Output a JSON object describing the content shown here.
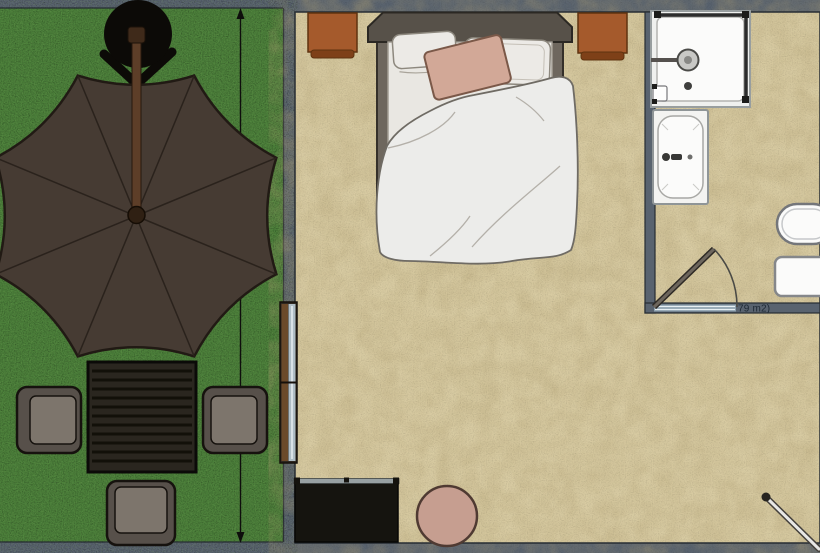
{
  "labels": {
    "area": "79 m2)"
  },
  "colors": {
    "wall": "#59636f",
    "wall_edge": "#262c33",
    "grass": "#4b7f3a",
    "floor": "#d8cba2",
    "umbrella": "#463b33",
    "umbrella_outline": "#211a14",
    "umbrella_rib": "#2a221c",
    "pole": "#5d3e28",
    "stand": "#0c0a07",
    "table": "#2a261f",
    "table_slat": "#121009",
    "chair_frame": "#57504a",
    "chair_seat": "#7d756c",
    "nightstand": "#a55a2c",
    "nightstand_edge": "#7e4018",
    "headboard": "#575149",
    "bed_frame": "#6e675e",
    "mattress": "#e9e7e2",
    "pillow": "#eceae6",
    "accent_pillow": "#d2a897",
    "duvet": "#ececea",
    "window_frame": "#6b4a2a",
    "window_glass": "#aebcc4",
    "tv": "#15140f",
    "tv_top": "#97a0a2",
    "pouf": "#c69e90",
    "fixture": "#fbfbfa",
    "fixture_border": "#85878a",
    "glass_door": "#2c2c2c",
    "threshold": "#8fa3b0",
    "label_text": "#1d2833",
    "dimension": "#0e0e0c",
    "rod": "#e8e8e6",
    "door_leaf": "#6d665d"
  }
}
